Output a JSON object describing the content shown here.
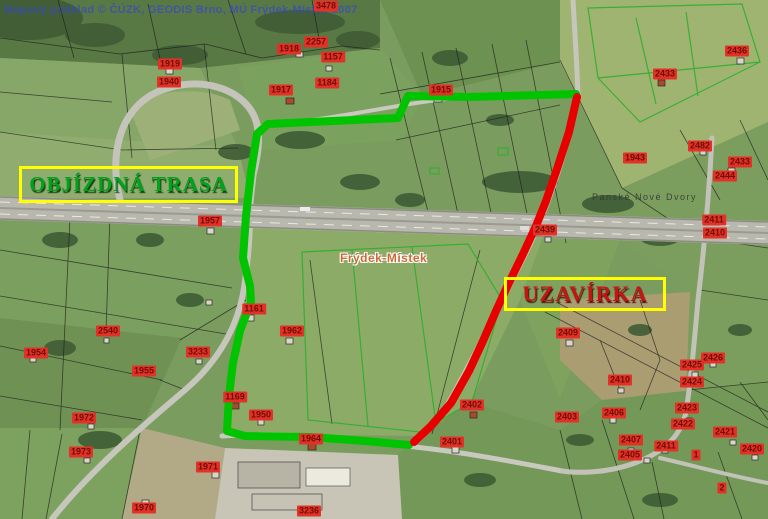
{
  "map": {
    "copyright": "Mapový podklad © ČÚZK, GEODIS Brno, MÚ Frýdek-Místek 2007",
    "labels": {
      "detour": "OBJÍZDNÁ TRASA",
      "closure": "UZAVÍRKA"
    },
    "routes": {
      "detour": {
        "name": "objízdná trasa (detour route)",
        "color": "#00c400"
      },
      "closure": {
        "name": "uzavírka (road closure)",
        "color": "#e60000"
      }
    },
    "accent_colors": {
      "label_box_border": "#ffff00",
      "detour_text": "#00a31c",
      "closure_text": "#c41414",
      "parcel_chip_bg": "#e23227",
      "parcel_chip_text": "#6e0e06",
      "copyright_text": "#3746cd"
    },
    "place_labels": [
      {
        "text": "Frýdek-Místek",
        "x": 340,
        "y": 251,
        "style": "city"
      },
      {
        "text": "Panské Nové Dvory",
        "x": 592,
        "y": 192,
        "style": "district"
      }
    ],
    "parcel_numbers": [
      {
        "text": "3478",
        "x": 326,
        "y": 6
      },
      {
        "text": "1919",
        "x": 170,
        "y": 64
      },
      {
        "text": "1940",
        "x": 169,
        "y": 82
      },
      {
        "text": "2257",
        "x": 316,
        "y": 42
      },
      {
        "text": "1157",
        "x": 333,
        "y": 57
      },
      {
        "text": "1918",
        "x": 289,
        "y": 49
      },
      {
        "text": "1917",
        "x": 281,
        "y": 90
      },
      {
        "text": "1184",
        "x": 327,
        "y": 83
      },
      {
        "text": "1915",
        "x": 441,
        "y": 90
      },
      {
        "text": "2436",
        "x": 737,
        "y": 51
      },
      {
        "text": "2433",
        "x": 665,
        "y": 74
      },
      {
        "text": "2482",
        "x": 700,
        "y": 146
      },
      {
        "text": "1943",
        "x": 635,
        "y": 158
      },
      {
        "text": "2433",
        "x": 740,
        "y": 162
      },
      {
        "text": "2444",
        "x": 725,
        "y": 176
      },
      {
        "text": "1957",
        "x": 210,
        "y": 221
      },
      {
        "text": "2411",
        "x": 714,
        "y": 220
      },
      {
        "text": "2410",
        "x": 715,
        "y": 233
      },
      {
        "text": "2439",
        "x": 545,
        "y": 230
      },
      {
        "text": "1161",
        "x": 254,
        "y": 309
      },
      {
        "text": "1962",
        "x": 292,
        "y": 331
      },
      {
        "text": "2540",
        "x": 108,
        "y": 331
      },
      {
        "text": "2409",
        "x": 568,
        "y": 333
      },
      {
        "text": "1954",
        "x": 36,
        "y": 353
      },
      {
        "text": "3233",
        "x": 198,
        "y": 352
      },
      {
        "text": "1955",
        "x": 144,
        "y": 371
      },
      {
        "text": "2426",
        "x": 713,
        "y": 358
      },
      {
        "text": "2425",
        "x": 692,
        "y": 365
      },
      {
        "text": "2424",
        "x": 692,
        "y": 382
      },
      {
        "text": "2410",
        "x": 620,
        "y": 380
      },
      {
        "text": "1169",
        "x": 235,
        "y": 397
      },
      {
        "text": "2402",
        "x": 472,
        "y": 405
      },
      {
        "text": "2423",
        "x": 687,
        "y": 408
      },
      {
        "text": "2406",
        "x": 614,
        "y": 413
      },
      {
        "text": "1950",
        "x": 261,
        "y": 415
      },
      {
        "text": "2403",
        "x": 567,
        "y": 417
      },
      {
        "text": "1972",
        "x": 84,
        "y": 418
      },
      {
        "text": "2422",
        "x": 683,
        "y": 424
      },
      {
        "text": "2421",
        "x": 725,
        "y": 432
      },
      {
        "text": "1964",
        "x": 311,
        "y": 439
      },
      {
        "text": "2407",
        "x": 631,
        "y": 440
      },
      {
        "text": "2401",
        "x": 452,
        "y": 442
      },
      {
        "text": "2411",
        "x": 666,
        "y": 446
      },
      {
        "text": "2420",
        "x": 752,
        "y": 449
      },
      {
        "text": "1973",
        "x": 81,
        "y": 452
      },
      {
        "text": "2405",
        "x": 630,
        "y": 455
      },
      {
        "text": "1",
        "x": 696,
        "y": 455
      },
      {
        "text": "1971",
        "x": 208,
        "y": 467
      },
      {
        "text": "2",
        "x": 722,
        "y": 488
      },
      {
        "text": "1970",
        "x": 144,
        "y": 508
      },
      {
        "text": "3236",
        "x": 309,
        "y": 511
      }
    ]
  }
}
